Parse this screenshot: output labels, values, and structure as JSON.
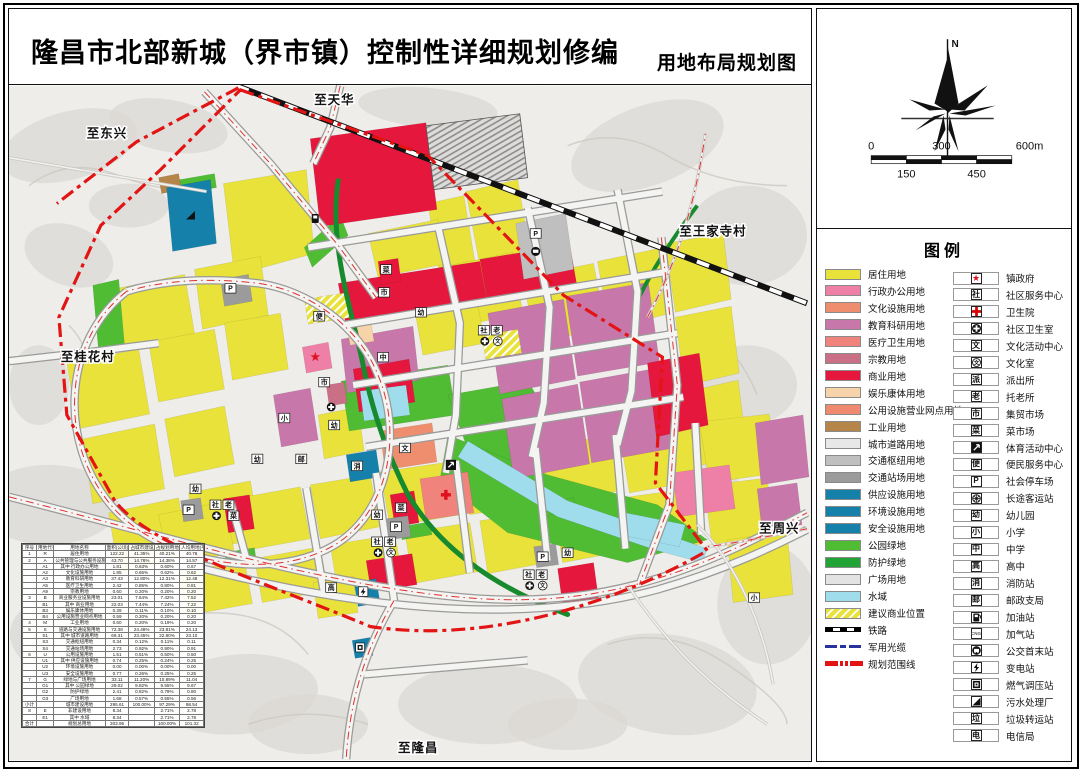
{
  "header": {
    "title": "隆昌市北部新城（界市镇）控制性详细规划修编",
    "subtitle": "用地布局规划图"
  },
  "north": {
    "label": "N"
  },
  "scalebar": {
    "top_labels": [
      "0",
      "300",
      "600m"
    ],
    "bottom_labels": [
      "150",
      "450"
    ]
  },
  "colors": {
    "residential": "#e9e23b",
    "admin": "#ee7fa7",
    "culture": "#ef8e6e",
    "education": "#c877ab",
    "medical": "#f0837b",
    "religion": "#c96f86",
    "commercial": "#e6173c",
    "entertainment": "#f6d3a8",
    "utility_retail": "#ef8a70",
    "industry": "#b5854a",
    "road": "#e8e8e8",
    "hub": "#bfbfbf",
    "station": "#9b9b9b",
    "utility_blue": "#1581ab",
    "park": "#4fbc34",
    "protect": "#22a335",
    "plaza": "#e3e3e3",
    "water": "#9fdcec",
    "boundary": "#e21414",
    "rail": "#111111",
    "cable": "#27339b",
    "corridor": "#178a2e"
  },
  "legend": {
    "title": "图例",
    "land_use": [
      {
        "label": "居住用地",
        "kind": "color",
        "color": "#e9e23b"
      },
      {
        "label": "行政办公用地",
        "kind": "color",
        "color": "#ee7fa7"
      },
      {
        "label": "文化设施用地",
        "kind": "color",
        "color": "#ef8e6e"
      },
      {
        "label": "教育科研用地",
        "kind": "color",
        "color": "#c877ab"
      },
      {
        "label": "医疗卫生用地",
        "kind": "color",
        "color": "#f0837b"
      },
      {
        "label": "宗教用地",
        "kind": "color",
        "color": "#c96f86"
      },
      {
        "label": "商业用地",
        "kind": "color",
        "color": "#e6173c"
      },
      {
        "label": "娱乐康体用地",
        "kind": "color",
        "color": "#f6d3a8"
      },
      {
        "label": "公用设施营业网点用地",
        "kind": "color",
        "color": "#ef8a70"
      },
      {
        "label": "工业用地",
        "kind": "color",
        "color": "#b5854a"
      },
      {
        "label": "城市道路用地",
        "kind": "color",
        "color": "#e8e8e8"
      },
      {
        "label": "交通枢纽用地",
        "kind": "color",
        "color": "#bfbfbf"
      },
      {
        "label": "交通站场用地",
        "kind": "color",
        "color": "#9b9b9b"
      },
      {
        "label": "供应设施用地",
        "kind": "color",
        "color": "#1581ab"
      },
      {
        "label": "环境设施用地",
        "kind": "color",
        "color": "#1581ab"
      },
      {
        "label": "安全设施用地",
        "kind": "color",
        "color": "#1581ab"
      },
      {
        "label": "公园绿地",
        "kind": "color",
        "color": "#4fbc34"
      },
      {
        "label": "防护绿地",
        "kind": "color",
        "color": "#22a335"
      },
      {
        "label": "广场用地",
        "kind": "color",
        "color": "#e3e3e3"
      },
      {
        "label": "水域",
        "kind": "color",
        "color": "#9fdcec"
      },
      {
        "label": "建议商业位置",
        "kind": "hatch"
      },
      {
        "label": "铁路",
        "kind": "rail"
      },
      {
        "label": "军用光缆",
        "kind": "cable"
      },
      {
        "label": "规划范围线",
        "kind": "boundary"
      }
    ],
    "facilities": [
      {
        "label": "镇政府",
        "icon": "star"
      },
      {
        "label": "社区服务中心",
        "icon": "char",
        "ch": "社"
      },
      {
        "label": "卫生院",
        "icon": "cross"
      },
      {
        "label": "社区卫生室",
        "icon": "oplus"
      },
      {
        "label": "文化活动中心",
        "icon": "char",
        "ch": "文"
      },
      {
        "label": "文化室",
        "icon": "circ",
        "ch": "文"
      },
      {
        "label": "派出所",
        "icon": "char",
        "ch": "派"
      },
      {
        "label": "托老所",
        "icon": "char",
        "ch": "老"
      },
      {
        "label": "集贸市场",
        "icon": "char",
        "ch": "市"
      },
      {
        "label": "菜市场",
        "icon": "char",
        "ch": "菜"
      },
      {
        "label": "体育活动中心",
        "icon": "sport"
      },
      {
        "label": "便民服务中心",
        "icon": "char",
        "ch": "便"
      },
      {
        "label": "社会停车场",
        "icon": "char",
        "ch": "P"
      },
      {
        "label": "长途客运站",
        "icon": "wheel"
      },
      {
        "label": "幼儿园",
        "icon": "char",
        "ch": "幼"
      },
      {
        "label": "小学",
        "icon": "char",
        "ch": "小"
      },
      {
        "label": "中学",
        "icon": "char",
        "ch": "中"
      },
      {
        "label": "高中",
        "icon": "char",
        "ch": "高"
      },
      {
        "label": "消防站",
        "icon": "char",
        "ch": "消"
      },
      {
        "label": "邮政支局",
        "icon": "char",
        "ch": "邮"
      },
      {
        "label": "加油站",
        "icon": "pump"
      },
      {
        "label": "加气站",
        "icon": "cng",
        "ch": "CNG"
      },
      {
        "label": "公交首末站",
        "icon": "bus"
      },
      {
        "label": "变电站",
        "icon": "bolt"
      },
      {
        "label": "燃气调压站",
        "icon": "gas"
      },
      {
        "label": "污水处理厂",
        "icon": "tri"
      },
      {
        "label": "垃圾转运站",
        "icon": "char",
        "ch": "垃"
      },
      {
        "label": "电信局",
        "icon": "char",
        "ch": "电"
      }
    ]
  },
  "map": {
    "road_labels": [
      {
        "text": "至天华",
        "x": 306,
        "y": 18
      },
      {
        "text": "至东兴",
        "x": 78,
        "y": 52
      },
      {
        "text": "至桂花村",
        "x": 52,
        "y": 276
      },
      {
        "text": "至王家寺村",
        "x": 672,
        "y": 150
      },
      {
        "text": "至周兴",
        "x": 752,
        "y": 448
      },
      {
        "text": "至隆昌",
        "x": 390,
        "y": 668
      }
    ],
    "markers": [
      {
        "t": "char",
        "ch": "P",
        "x": 222,
        "y": 203
      },
      {
        "t": "char",
        "ch": "P",
        "x": 180,
        "y": 425
      },
      {
        "t": "char",
        "ch": "P",
        "x": 388,
        "y": 442
      },
      {
        "t": "char",
        "ch": "P",
        "x": 535,
        "y": 472
      },
      {
        "t": "char",
        "ch": "P",
        "x": 528,
        "y": 148
      },
      {
        "t": "char",
        "ch": "幼",
        "x": 413,
        "y": 227
      },
      {
        "t": "char",
        "ch": "幼",
        "x": 326,
        "y": 340
      },
      {
        "t": "char",
        "ch": "幼",
        "x": 249,
        "y": 374
      },
      {
        "t": "char",
        "ch": "幼",
        "x": 187,
        "y": 404
      },
      {
        "t": "char",
        "ch": "幼",
        "x": 369,
        "y": 430
      },
      {
        "t": "char",
        "ch": "幼",
        "x": 560,
        "y": 468
      },
      {
        "t": "char",
        "ch": "小",
        "x": 276,
        "y": 333
      },
      {
        "t": "char",
        "ch": "小",
        "x": 747,
        "y": 513
      },
      {
        "t": "char",
        "ch": "中",
        "x": 375,
        "y": 272
      },
      {
        "t": "char",
        "ch": "高",
        "x": 323,
        "y": 503
      },
      {
        "t": "char",
        "ch": "社",
        "x": 476,
        "y": 245
      },
      {
        "t": "char",
        "ch": "老",
        "x": 489,
        "y": 245
      },
      {
        "t": "oplus",
        "x": 477,
        "y": 256
      },
      {
        "t": "circ",
        "ch": "文",
        "x": 490,
        "y": 256
      },
      {
        "t": "char",
        "ch": "社",
        "x": 369,
        "y": 457
      },
      {
        "t": "char",
        "ch": "老",
        "x": 382,
        "y": 457
      },
      {
        "t": "oplus",
        "x": 370,
        "y": 468
      },
      {
        "t": "circ",
        "ch": "文",
        "x": 383,
        "y": 468
      },
      {
        "t": "char",
        "ch": "社",
        "x": 521,
        "y": 490
      },
      {
        "t": "char",
        "ch": "老",
        "x": 534,
        "y": 490
      },
      {
        "t": "oplus",
        "x": 522,
        "y": 501
      },
      {
        "t": "circ",
        "ch": "文",
        "x": 535,
        "y": 501
      },
      {
        "t": "char",
        "ch": "社",
        "x": 207,
        "y": 420
      },
      {
        "t": "char",
        "ch": "老",
        "x": 220,
        "y": 420
      },
      {
        "t": "oplus",
        "x": 208,
        "y": 431
      },
      {
        "t": "char",
        "ch": "菜",
        "x": 225,
        "y": 431
      },
      {
        "t": "char",
        "ch": "市",
        "x": 376,
        "y": 207
      },
      {
        "t": "char",
        "ch": "市",
        "x": 316,
        "y": 297
      },
      {
        "t": "char",
        "ch": "菜",
        "x": 378,
        "y": 184
      },
      {
        "t": "char",
        "ch": "菜",
        "x": 393,
        "y": 423
      },
      {
        "t": "char",
        "ch": "便",
        "x": 311,
        "y": 231
      },
      {
        "t": "char",
        "ch": "邮",
        "x": 293,
        "y": 374
      },
      {
        "t": "char",
        "ch": "消",
        "x": 349,
        "y": 381
      },
      {
        "t": "char",
        "ch": "文",
        "x": 397,
        "y": 363
      },
      {
        "t": "oplus",
        "x": 323,
        "y": 322
      },
      {
        "t": "star",
        "x": 307,
        "y": 272
      },
      {
        "t": "cross",
        "x": 438,
        "y": 410
      },
      {
        "t": "sport",
        "x": 443,
        "y": 380
      },
      {
        "t": "bolt",
        "x": 355,
        "y": 507
      },
      {
        "t": "gas",
        "x": 352,
        "y": 563
      },
      {
        "t": "tri",
        "x": 182,
        "y": 130
      },
      {
        "t": "pump",
        "x": 307,
        "y": 133
      },
      {
        "t": "bus",
        "x": 528,
        "y": 166
      }
    ]
  },
  "table": {
    "headers": [
      "序号",
      "用地代号",
      "用地名称",
      "面积(公顷)",
      "占城市建设用地比例(%)",
      "占规划用地比例(%)",
      "人均用地(平方米/人)"
    ],
    "rows": [
      [
        "1",
        "R",
        "居住用地",
        "122.22",
        "41.35%",
        "40.21%",
        "40.76"
      ],
      [
        "2",
        "A",
        "公共管理与公共服务设施用地",
        "43.70",
        "14.78%",
        "14.38%",
        "14.57"
      ],
      [
        "",
        "A1",
        "其中 行政办公用地",
        "1.81",
        "0.63%",
        "0.60%",
        "0.67"
      ],
      [
        "",
        "A2",
        "文化设施用地",
        "1.85",
        "0.65%",
        "0.62%",
        "0.62"
      ],
      [
        "",
        "A3",
        "教育科研用地",
        "37.43",
        "12.80%",
        "12.31%",
        "12.48"
      ],
      [
        "",
        "A5",
        "医疗卫生用地",
        "2.42",
        "0.85%",
        "0.80%",
        "0.81"
      ],
      [
        "",
        "A9",
        "宗教用地",
        "0.60",
        "0.20%",
        "0.20%",
        "0.20"
      ],
      [
        "3",
        "B",
        "商业服务业设施用地",
        "23.01",
        "7.64%",
        "7.42%",
        "7.52"
      ],
      [
        "",
        "B1",
        "其中 商业用地",
        "22.03",
        "7.44%",
        "7.24%",
        "7.22"
      ],
      [
        "",
        "B3",
        "娱乐康体用地",
        "0.39",
        "0.11%",
        "0.10%",
        "0.10"
      ],
      [
        "",
        "B4",
        "公用设施营业网点用地",
        "0.59",
        "0.20%",
        "0.20%",
        "0.20"
      ],
      [
        "4",
        "M",
        "工业用地",
        "0.60",
        "0.20%",
        "0.19%",
        "0.20"
      ],
      [
        "5",
        "S",
        "道路与交通设施用地",
        "72.38",
        "24.48%",
        "23.81%",
        "24.13"
      ],
      [
        "",
        "S1",
        "其中 城市道路用地",
        "69.31",
        "23.45%",
        "22.80%",
        "23.10"
      ],
      [
        "",
        "S3",
        "交通枢纽用地",
        "0.34",
        "0.12%",
        "0.11%",
        "0.11"
      ],
      [
        "",
        "S4",
        "交通站场用地",
        "2.73",
        "0.92%",
        "0.90%",
        "0.91"
      ],
      [
        "6",
        "U",
        "公用设施用地",
        "1.51",
        "0.51%",
        "0.50%",
        "0.50"
      ],
      [
        "",
        "U1",
        "其中 供应设施用地",
        "0.74",
        "0.25%",
        "0.24%",
        "0.25"
      ],
      [
        "",
        "U2",
        "环境设施用地",
        "0.00",
        "0.00%",
        "0.00%",
        "0.00"
      ],
      [
        "",
        "U3",
        "安全设施用地",
        "0.77",
        "0.26%",
        "0.25%",
        "0.25"
      ],
      [
        "7",
        "G",
        "绿地与广场用地",
        "33.11",
        "11.20%",
        "10.89%",
        "11.04"
      ],
      [
        "",
        "G1",
        "其中 公园绿地",
        "29.02",
        "9.82%",
        "9.55%",
        "9.67"
      ],
      [
        "",
        "G2",
        "防护绿地",
        "2.41",
        "0.82%",
        "0.79%",
        "0.80"
      ],
      [
        "",
        "G3",
        "广场用地",
        "1.68",
        "0.57%",
        "0.55%",
        "0.56"
      ],
      [
        "小计",
        "",
        "城市建设用地",
        "295.61",
        "100.00%",
        "97.29%",
        "98.54"
      ],
      [
        "8",
        "E",
        "非建设用地",
        "8.34",
        "",
        "2.71%",
        "2.78"
      ],
      [
        "",
        "E1",
        "其中 水域",
        "8.34",
        "",
        "2.71%",
        "2.78"
      ],
      [
        "合计",
        "",
        "规划总用地",
        "303.95",
        "",
        "100.00%",
        "101.32"
      ]
    ]
  }
}
